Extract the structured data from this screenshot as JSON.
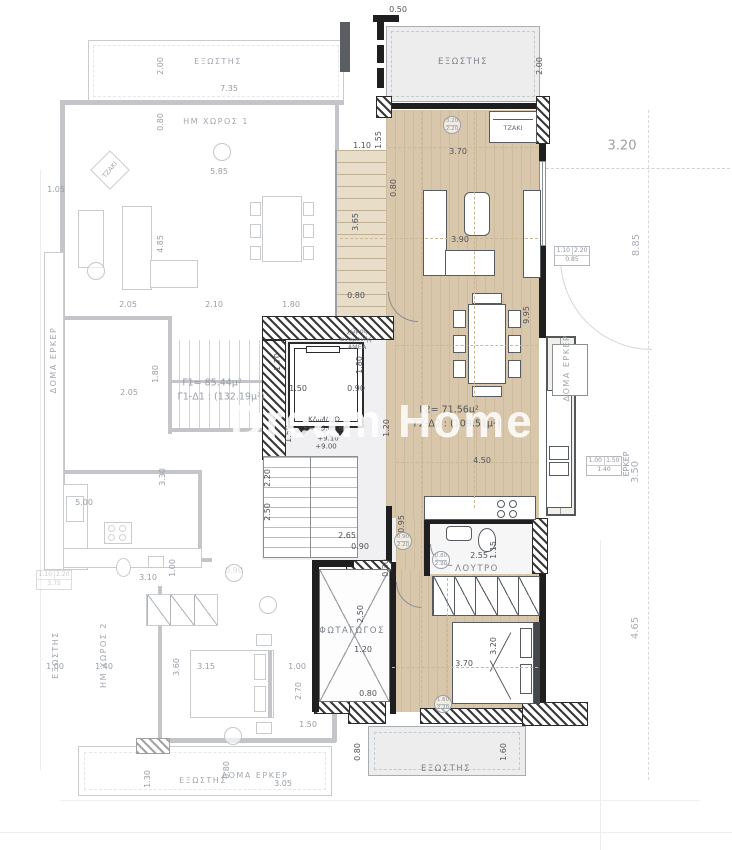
{
  "watermark": "Dream Home",
  "colors": {
    "unit_floor": "#d9c7ab",
    "stair_floor": "#e8ddc9",
    "balcony": "#ededed",
    "wall": "#1f1f1f",
    "dimension_text": "#4f545a",
    "faded_text": "#989ea6",
    "watermark": "#ffffff"
  },
  "units": {
    "unit1": {
      "area": "Γ1= 85.44μ²",
      "total": "Γ1-Δ1 : (132.19μ²)"
    },
    "unit2": {
      "area": "Γ2= 71.56μ²",
      "total": "Γ2-Δ2 : (109.51μ²)"
    },
    "stairwell": {
      "name": "ΚΛΙΜ/ΣΙΟ",
      "area": "E= 15.80 m²",
      "levels": [
        "+9.10",
        "+9.00"
      ]
    }
  },
  "dim_tables": {
    "t1": {
      "a": "1.10",
      "b": "2.20",
      "c": "0.85"
    },
    "t2": {
      "a": "1.00",
      "b": "1.50",
      "c": "1.40"
    },
    "t3": {
      "a": "1.10",
      "b": "2.20",
      "c": "3.75"
    }
  },
  "annotations": [
    {
      "t": "0.50",
      "x": 398,
      "y": 10,
      "c": "d"
    },
    {
      "t": "2.00",
      "x": 540,
      "y": 66,
      "r": -90,
      "c": "d"
    },
    {
      "t": "ΕΞΩΣΤΗΣ",
      "x": 463,
      "y": 62,
      "c": "r"
    },
    {
      "t": "ΤΖΑΚΙ",
      "x": 513,
      "y": 128,
      "c": "t"
    },
    {
      "t": "3.70",
      "x": 458,
      "y": 152,
      "c": "d"
    },
    {
      "t": "1.55",
      "x": 379,
      "y": 140,
      "r": -90,
      "c": "d"
    },
    {
      "t": "1.10",
      "x": 362,
      "y": 146,
      "c": "d"
    },
    {
      "t": "0.80",
      "x": 394,
      "y": 188,
      "r": -90,
      "c": "d"
    },
    {
      "t": "3.65",
      "x": 356,
      "y": 222,
      "r": -90,
      "c": "d"
    },
    {
      "t": "0.80",
      "x": 356,
      "y": 296,
      "c": "d"
    },
    {
      "t": "3.90",
      "x": 460,
      "y": 240,
      "c": "d"
    },
    {
      "t": "9.95",
      "x": 527,
      "y": 315,
      "r": -90,
      "c": "d"
    },
    {
      "t": "χώρος",
      "x": 357,
      "y": 331,
      "c": "t"
    },
    {
      "t": "αναμονής",
      "x": 356,
      "y": 339,
      "c": "t"
    },
    {
      "t": "ΑΜΕΑ",
      "x": 357,
      "y": 347,
      "c": "t"
    },
    {
      "t": "1.70",
      "x": 278,
      "y": 362,
      "r": -90,
      "c": "d"
    },
    {
      "t": "1.80",
      "x": 360,
      "y": 365,
      "r": -90,
      "c": "d"
    },
    {
      "t": "1.50",
      "x": 298,
      "y": 389,
      "c": "d"
    },
    {
      "t": "0.90",
      "x": 356,
      "y": 389,
      "c": "d"
    },
    {
      "t": "Γ2= 71.56μ²",
      "x": 449,
      "y": 410,
      "c": "a"
    },
    {
      "t": "Γ2-Δ2 : (109.51μ²)",
      "x": 457,
      "y": 424,
      "c": "a"
    },
    {
      "t": "ΚΛΙΜ/ΣΙΟ",
      "x": 324,
      "y": 420,
      "c": "a2"
    },
    {
      "t": "E= 15.80 m²",
      "x": 326,
      "y": 429,
      "c": "a2"
    },
    {
      "t": "+9.10",
      "x": 328,
      "y": 439,
      "c": "l"
    },
    {
      "t": "+9.00",
      "x": 326,
      "y": 447,
      "c": "l"
    },
    {
      "t": "1.20",
      "x": 387,
      "y": 428,
      "r": -90,
      "c": "d"
    },
    {
      "t": "1.50",
      "x": 289,
      "y": 434,
      "r": -90,
      "c": "d"
    },
    {
      "t": "4.50",
      "x": 482,
      "y": 461,
      "c": "d"
    },
    {
      "t": "2.20",
      "x": 268,
      "y": 478,
      "r": -90,
      "c": "d"
    },
    {
      "t": "2.50",
      "x": 268,
      "y": 512,
      "r": -90,
      "c": "d"
    },
    {
      "t": "0.95",
      "x": 402,
      "y": 524,
      "r": -90,
      "c": "d"
    },
    {
      "t": "2.65",
      "x": 347,
      "y": 536,
      "c": "d"
    },
    {
      "t": "0.90",
      "x": 360,
      "y": 547,
      "c": "d"
    },
    {
      "t": "2.55",
      "x": 479,
      "y": 556,
      "c": "d"
    },
    {
      "t": "1.15",
      "x": 494,
      "y": 550,
      "r": -90,
      "c": "d"
    },
    {
      "t": "ΛΟΥΤΡΟ",
      "x": 477,
      "y": 569,
      "c": "r"
    },
    {
      "t": "0.30",
      "x": 386,
      "y": 568,
      "r": -90,
      "c": "d"
    },
    {
      "t": "2.50",
      "x": 361,
      "y": 614,
      "r": -90,
      "c": "d"
    },
    {
      "t": "ΦΩΤΑΓΩΓΟΣ",
      "x": 352,
      "y": 631,
      "c": "r"
    },
    {
      "t": "1.20",
      "x": 363,
      "y": 650,
      "c": "d"
    },
    {
      "t": "0.80",
      "x": 368,
      "y": 694,
      "c": "d"
    },
    {
      "t": "3.70",
      "x": 464,
      "y": 664,
      "c": "d"
    },
    {
      "t": "3.20",
      "x": 494,
      "y": 646,
      "r": -90,
      "c": "d"
    },
    {
      "t": "ΕΞΩΣΤΗΣ",
      "x": 446,
      "y": 769,
      "c": "r"
    },
    {
      "t": "0.80",
      "x": 358,
      "y": 752,
      "r": -90,
      "c": "d"
    },
    {
      "t": "1.60",
      "x": 504,
      "y": 752,
      "r": -90,
      "c": "d"
    },
    {
      "t": "ΕΞΩΣΤΗΣ",
      "x": 218,
      "y": 62,
      "c": "rf"
    },
    {
      "t": "7.35",
      "x": 229,
      "y": 89,
      "c": "df"
    },
    {
      "t": "2.00",
      "x": 161,
      "y": 66,
      "r": -90,
      "c": "df"
    },
    {
      "t": "0.80",
      "x": 161,
      "y": 122,
      "r": -90,
      "c": "df"
    },
    {
      "t": "ΗΜ ΧΩΡΟΣ 1",
      "x": 216,
      "y": 122,
      "c": "rf"
    },
    {
      "t": "5.85",
      "x": 219,
      "y": 172,
      "c": "df"
    },
    {
      "t": "1.05",
      "x": 56,
      "y": 190,
      "c": "df"
    },
    {
      "t": "ΤΖΑΚΙ",
      "x": 110,
      "y": 170,
      "r": -50,
      "c": "tf"
    },
    {
      "t": "4.85",
      "x": 161,
      "y": 244,
      "r": -90,
      "c": "df"
    },
    {
      "t": "2.05",
      "x": 128,
      "y": 305,
      "c": "df"
    },
    {
      "t": "2.10",
      "x": 214,
      "y": 305,
      "c": "df"
    },
    {
      "t": "1.80",
      "x": 291,
      "y": 305,
      "c": "df"
    },
    {
      "t": "ΔΟΜΑ ΕΡΚΕΡ",
      "x": 54,
      "y": 360,
      "r": -90,
      "c": "rf"
    },
    {
      "t": "2.05",
      "x": 129,
      "y": 393,
      "c": "df"
    },
    {
      "t": "1.80",
      "x": 156,
      "y": 374,
      "r": -90,
      "c": "df"
    },
    {
      "t": "Γ1= 85.44μ²",
      "x": 212,
      "y": 383,
      "c": "af"
    },
    {
      "t": "Γ1-Δ1 : (132.19μ²)",
      "x": 221,
      "y": 397,
      "c": "af"
    },
    {
      "t": "3.30",
      "x": 163,
      "y": 477,
      "r": -90,
      "c": "df"
    },
    {
      "t": "5.00",
      "x": 84,
      "y": 503,
      "c": "df"
    },
    {
      "t": "3.10",
      "x": 148,
      "y": 578,
      "c": "df"
    },
    {
      "t": "1.00",
      "x": 173,
      "y": 568,
      "r": -90,
      "c": "df"
    },
    {
      "t": "0.90",
      "x": 234,
      "y": 571,
      "c": "df"
    },
    {
      "t": "ΕΞΩΣΤΗΣ",
      "x": 56,
      "y": 655,
      "r": -90,
      "c": "rf"
    },
    {
      "t": "ΗΜ ΧΩΡΟΣ 2",
      "x": 104,
      "y": 655,
      "r": -90,
      "c": "rf"
    },
    {
      "t": "1.00",
      "x": 55,
      "y": 667,
      "c": "df"
    },
    {
      "t": "1.40",
      "x": 104,
      "y": 667,
      "c": "df"
    },
    {
      "t": "3.60",
      "x": 177,
      "y": 667,
      "r": -90,
      "c": "df"
    },
    {
      "t": "3.15",
      "x": 206,
      "y": 667,
      "c": "df"
    },
    {
      "t": "1.00",
      "x": 297,
      "y": 667,
      "c": "df"
    },
    {
      "t": "2.70",
      "x": 299,
      "y": 691,
      "r": -90,
      "c": "df"
    },
    {
      "t": "1.50",
      "x": 308,
      "y": 725,
      "c": "df"
    },
    {
      "t": "ΕΞΩΣΤΗΣ",
      "x": 203,
      "y": 781,
      "c": "rf"
    },
    {
      "t": "ΔΟΜΑ ΕΡΚΕΡ",
      "x": 255,
      "y": 776,
      "c": "rf"
    },
    {
      "t": "3.05",
      "x": 283,
      "y": 784,
      "c": "df"
    },
    {
      "t": "0.80",
      "x": 227,
      "y": 770,
      "r": -90,
      "c": "df"
    },
    {
      "t": "1.30",
      "x": 148,
      "y": 779,
      "r": -90,
      "c": "df"
    },
    {
      "t": "3.20",
      "x": 622,
      "y": 146,
      "c": "b"
    },
    {
      "t": "8.85",
      "x": 637,
      "y": 245,
      "r": -90,
      "c": "m"
    },
    {
      "t": "ΔΟΜΑ ΕΡΚΕΡ",
      "x": 567,
      "y": 368,
      "r": -90,
      "c": "rf"
    },
    {
      "t": "ΕΡΚΕΡ",
      "x": 627,
      "y": 464,
      "r": -90,
      "c": "df"
    },
    {
      "t": "3.50",
      "x": 636,
      "y": 472,
      "r": -90,
      "c": "m"
    },
    {
      "t": "4.65",
      "x": 636,
      "y": 628,
      "r": -90,
      "c": "m"
    }
  ],
  "door_badges": [
    {
      "x": 452,
      "y": 125,
      "a": "3.20",
      "b": "2.20",
      "f": false
    },
    {
      "x": 403,
      "y": 541,
      "a": "0.90",
      "b": "2.20",
      "f": false
    },
    {
      "x": 441,
      "y": 560,
      "a": "0.80",
      "b": "2.20",
      "f": false
    },
    {
      "x": 443,
      "y": 704,
      "a": "1.60",
      "b": "2.20",
      "f": false
    },
    {
      "x": 222,
      "y": 152,
      "a": "",
      "b": "",
      "f": true
    },
    {
      "x": 96,
      "y": 271,
      "a": "",
      "b": "",
      "f": true
    },
    {
      "x": 234,
      "y": 573,
      "a": "",
      "b": "",
      "f": true
    },
    {
      "x": 268,
      "y": 605,
      "a": "",
      "b": "",
      "f": true
    },
    {
      "x": 233,
      "y": 736,
      "a": "",
      "b": "",
      "f": true
    }
  ]
}
